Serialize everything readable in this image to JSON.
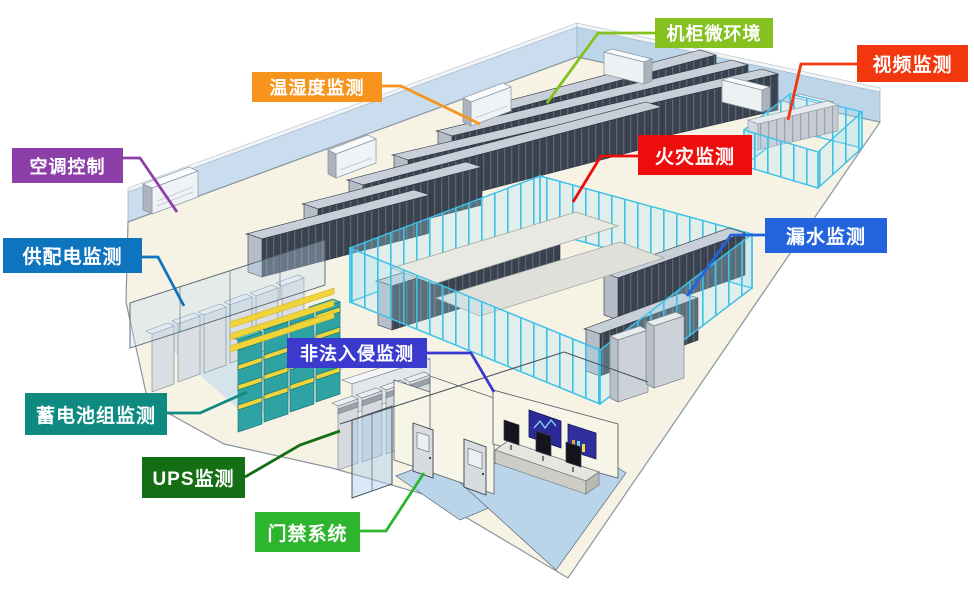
{
  "diagram": {
    "type": "isometric-datacenter-monitoring-overview",
    "labels": [
      {
        "id": "cabinet-microenvironment",
        "text": "机柜微环境",
        "color": "#85C21F"
      },
      {
        "id": "video-monitoring",
        "text": "视频监测",
        "color": "#F2360D"
      },
      {
        "id": "temperature-humidity-monitoring",
        "text": "温湿度监测",
        "color": "#F7941D"
      },
      {
        "id": "air-conditioning-control",
        "text": "空调控制",
        "color": "#8C3FA8"
      },
      {
        "id": "power-distribution-monitoring",
        "text": "供配电监测",
        "color": "#0F74BE"
      },
      {
        "id": "fire-monitoring",
        "text": "火灾监测",
        "color": "#EE0C0C"
      },
      {
        "id": "water-leak-monitoring",
        "text": "漏水监测",
        "color": "#2363DD"
      },
      {
        "id": "illegal-intrusion-monitoring",
        "text": "非法入侵监测",
        "color": "#3A3ACE"
      },
      {
        "id": "battery-pack-monitoring",
        "text": "蓄电池组监测",
        "color": "#0F8A80"
      },
      {
        "id": "ups-monitoring",
        "text": "UPS监测",
        "color": "#146E14"
      },
      {
        "id": "access-control-system",
        "text": "门禁系统",
        "color": "#2EB52E"
      }
    ]
  }
}
